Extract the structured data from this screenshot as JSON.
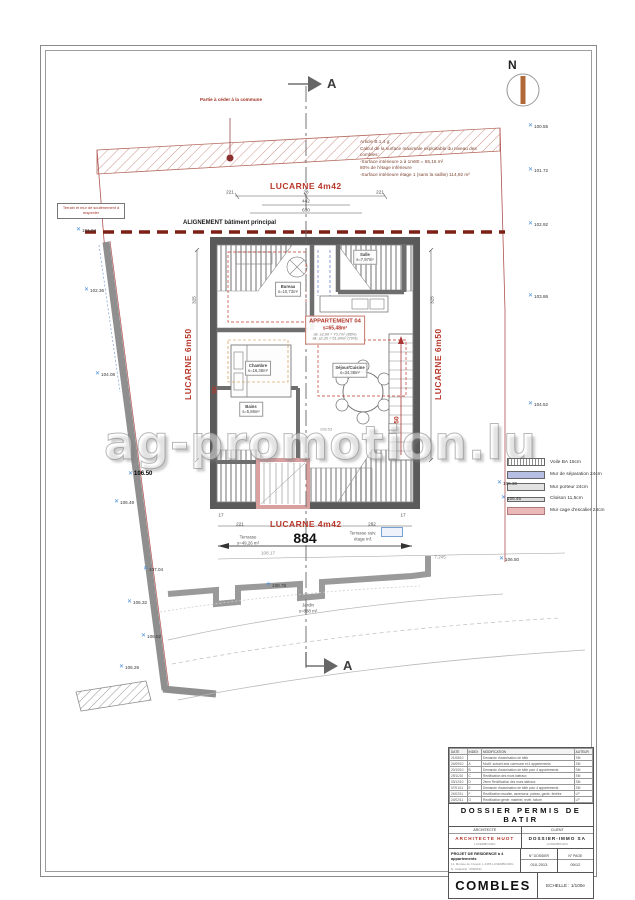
{
  "sheet": {
    "north": "N",
    "section": "A",
    "watermark": "ag-promotion.lu"
  },
  "notes": {
    "cede": "Partie à céder à la commune",
    "retain": "Terrain et mur de soutènement à respecter",
    "article": [
      "Article B.1.4 g:",
      "Calcul de la surface maximale exploitable du niveau des",
      "combles:",
      "-Surface intérieure ≥ à 1m80 = 65,16 m²",
      "80% de l'étage inférieure",
      "-Surface intérieure étage 1 (sans la saillie) 114,92 m²"
    ],
    "alignment": "ALIGNEMENT bâtiment principal"
  },
  "labels": {
    "lucarne_top": "LUCARNE 4m42",
    "lucarne_bottom": "LUCARNE 4m42",
    "lucarne_left": "LUCARNE 6m50",
    "lucarne_right": "LUCARNE 6m50",
    "fifty": "50",
    "apartment": "APPARTEMENT 04",
    "apartment_area": "s=65,48m²",
    "apartment_sub1": "alt. ≥2,00 = 70,7m² (86%)",
    "apartment_sub2": "alt. ≥2,20 = 51,94m² (79%)",
    "terrasse_left1": "Terrasse",
    "terrasse_left2": "s=49,26 m²",
    "terrasse_right1": "Terrasse suiv.",
    "terrasse_right2": "étage inf.",
    "jardin1": "Jardin",
    "jardin2": "s=888 m²",
    "terrace_level": "108.53"
  },
  "rooms": [
    {
      "name": "Bureau",
      "area": "s=10,73m²"
    },
    {
      "name": "Salle",
      "area": "s=7,97m²"
    },
    {
      "name": "Chambre",
      "area": "s=16,38m²"
    },
    {
      "name": "Séjour/Cuisine",
      "area": "s=34,38m²"
    },
    {
      "name": "Bains",
      "area": "s=5,86m²"
    }
  ],
  "dims": [
    "221",
    "28",
    "221",
    "442",
    "630",
    "17",
    "221",
    "262",
    "17",
    "884",
    "108.17",
    "7.245",
    "325",
    "325"
  ],
  "elevations": [
    "100.55",
    "101.72",
    "102.92",
    "103.86",
    "104.52",
    "106.30",
    "106.46",
    "106.50",
    "101.04",
    "102.36",
    "104.08",
    "106.50",
    "106.49",
    "107.04",
    "106.32",
    "106.52",
    "106.26",
    "108.78"
  ],
  "legend": {
    "items": [
      {
        "label": "Voile BA 15cm",
        "type": "hatch"
      },
      {
        "label": "Mur de séparation 24cm",
        "type": "blue"
      },
      {
        "label": "Mur porteur 24cm",
        "type": "gray"
      },
      {
        "label": "Cloison 11,5cm",
        "type": "thin"
      },
      {
        "label": "Mur cage d'escalier 24cm",
        "type": "pink"
      }
    ]
  },
  "titleblock": {
    "rev_headers": [
      "DATE",
      "INDEX",
      "MODIFICATION",
      "AUTEUR"
    ],
    "revisions": [
      [
        "21/08/10",
        "",
        "Demande d'autorisation de bâtir",
        "SM"
      ],
      [
        "24/09/10",
        "A",
        "Modif. suivant avis commune et 4 appartements",
        "SM"
      ],
      [
        "20/10/10",
        "B",
        "Demande d'autorisation de bâtir pour 4 appartements",
        "SM"
      ],
      [
        "29/11/10",
        "C",
        "Rectification des murs latéraux",
        "SM"
      ],
      [
        "03/12/10",
        "D",
        "2ème Rectification des murs latéraux",
        "SM"
      ],
      [
        "07/01/11",
        "E",
        "Demande d'autorisation de bâtir pour 4 appartements",
        "SM"
      ],
      [
        "24/02/11",
        "F",
        "Rectification escalier, ascenseur, poteau, garde, fenêtre",
        "LP"
      ],
      [
        "24/02/11",
        "G",
        "Rectification génér. matériel, revêt. toiture",
        "LP"
      ]
    ],
    "title": "DOSSIER PERMIS DE BATIR",
    "architect_header": "ARCHITECTE",
    "architect_name": "ARCHITECTE HUOT",
    "architect_sub": "LUXEMBOURG",
    "client_header": "CLIENT",
    "client_name": "DOSSIER-IMMO SA",
    "client_sub": "LUXEMBOURG",
    "project_title": "PROJET DE RESIDENCE à 4 appartements",
    "project_addr": "11, Montée de Crespin L-1365 LUXEMBOURG",
    "project_cad": "N. cadastral : 598/2611",
    "dossier_label": "N° DOSSIER",
    "dossier_value": "010-2013",
    "page_label": "N° PAGE",
    "page_value": "09/12",
    "sheet_name": "COMBLES",
    "scale": "ECHELLE : 1/100e"
  }
}
